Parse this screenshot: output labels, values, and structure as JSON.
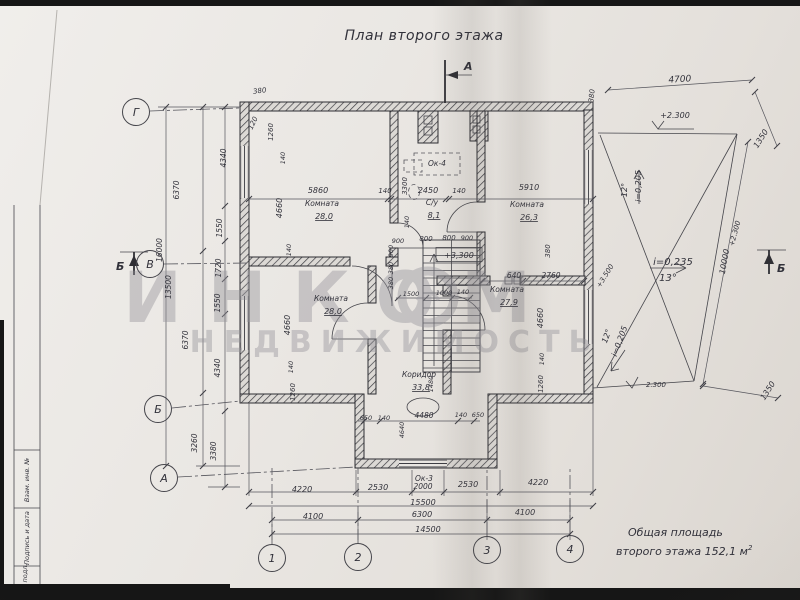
{
  "title": {
    "text": "План второго этажа"
  },
  "summary": {
    "line1": "Общая площадь",
    "line2": "второго этажа 152,1 м",
    "sup": "2"
  },
  "watermark": {
    "brand": "ИНКОМ",
    "sub": "НЕДВИЖИМОСТЬ"
  },
  "title_block_fields": [
    {
      "label": "Взам. инв. №"
    },
    {
      "label": "Подпись и дата"
    },
    {
      "label": "Инв. № подл."
    }
  ],
  "axis_bubbles": [
    {
      "label": "Г",
      "x": 136,
      "y": 112
    },
    {
      "label": "В",
      "x": 150,
      "y": 264
    },
    {
      "label": "Б",
      "x": 158,
      "y": 409
    },
    {
      "label": "А",
      "x": 164,
      "y": 478
    },
    {
      "label": "1",
      "x": 272,
      "y": 558
    },
    {
      "label": "2",
      "x": 358,
      "y": 557
    },
    {
      "label": "3",
      "x": 487,
      "y": 550
    },
    {
      "label": "4",
      "x": 570,
      "y": 549
    }
  ],
  "section_marks": [
    {
      "label": "А",
      "x": 464,
      "y": 70
    },
    {
      "label": "Б",
      "x": 116,
      "y": 270
    },
    {
      "label": "Б",
      "x": 777,
      "y": 272
    }
  ],
  "rooms": [
    {
      "name": "Комната",
      "area": "28,0",
      "x": 322,
      "y": 206
    },
    {
      "name": "С/у",
      "area": "8,1",
      "x": 432,
      "y": 205
    },
    {
      "name": "Комната",
      "area": "26,3",
      "x": 527,
      "y": 207
    },
    {
      "name": "Комната",
      "area": "28,0",
      "x": 331,
      "y": 301
    },
    {
      "name": "Комната",
      "area": "27,9",
      "x": 507,
      "y": 292
    },
    {
      "name": "Коридор",
      "area": "33,8",
      "x": 419,
      "y": 377
    }
  ],
  "window_labels": [
    {
      "label": "Ок-4",
      "x": 437,
      "y": 166
    },
    {
      "label": "Ок-3",
      "x": 424,
      "y": 481
    }
  ],
  "level_marks": [
    {
      "t": "+3,300",
      "x": 459,
      "y": 258,
      "fs": 8,
      "box": true
    },
    {
      "t": "+2.300",
      "x": 675,
      "y": 118,
      "fs": 8
    },
    {
      "t": "+2.300",
      "x": 737,
      "y": 234,
      "r": -75,
      "fs": 7
    },
    {
      "t": "+3.500",
      "x": 607,
      "y": 277,
      "r": -58,
      "fs": 7
    },
    {
      "t": "2.300",
      "x": 656,
      "y": 387,
      "fs": 7
    }
  ],
  "slope_marks": [
    {
      "t": "i=0,205",
      "x": 641,
      "y": 186,
      "r": -90,
      "fs": 8
    },
    {
      "t": "12°",
      "x": 627,
      "y": 190,
      "r": -90,
      "fs": 8
    },
    {
      "t": "i=0,235",
      "x": 673,
      "y": 265,
      "fs": 10
    },
    {
      "t": "13°",
      "x": 668,
      "y": 281,
      "fs": 10
    },
    {
      "t": "i=0,205",
      "x": 622,
      "y": 342,
      "r": -70,
      "fs": 8
    },
    {
      "t": "12°",
      "x": 609,
      "y": 337,
      "r": -70,
      "fs": 8
    }
  ],
  "dimensions": [
    {
      "t": "5860",
      "x": 318,
      "y": 193
    },
    {
      "t": "140",
      "x": 385,
      "y": 193,
      "fs": 7
    },
    {
      "t": "2450",
      "x": 428,
      "y": 193
    },
    {
      "t": "140",
      "x": 459,
      "y": 193,
      "fs": 7
    },
    {
      "t": "5910",
      "x": 529,
      "y": 190
    },
    {
      "t": "3300",
      "x": 407,
      "y": 186,
      "r": -90,
      "fs": 7
    },
    {
      "t": "380",
      "x": 260,
      "y": 93,
      "r": -8,
      "fs": 7
    },
    {
      "t": "120",
      "x": 255,
      "y": 124,
      "r": -65,
      "fs": 7
    },
    {
      "t": "1260",
      "x": 273,
      "y": 132,
      "r": -90,
      "fs": 7
    },
    {
      "t": "140",
      "x": 285,
      "y": 158,
      "r": -90,
      "fs": 6.5
    },
    {
      "t": "380",
      "x": 594,
      "y": 96,
      "r": -85,
      "fs": 7
    },
    {
      "t": "4660",
      "x": 282,
      "y": 208,
      "r": -90,
      "fs": 8
    },
    {
      "t": "140",
      "x": 291,
      "y": 250,
      "r": -90,
      "fs": 6.5
    },
    {
      "t": "140",
      "x": 409,
      "y": 222,
      "r": -90,
      "fs": 6.5
    },
    {
      "t": "900",
      "x": 398,
      "y": 243,
      "fs": 6.5
    },
    {
      "t": "800",
      "x": 426,
      "y": 241,
      "fs": 7
    },
    {
      "t": "800",
      "x": 449,
      "y": 240,
      "fs": 7
    },
    {
      "t": "900",
      "x": 467,
      "y": 240,
      "fs": 6.5
    },
    {
      "t": "900",
      "x": 393,
      "y": 251,
      "r": -90,
      "fs": 6.5
    },
    {
      "t": "380",
      "x": 393,
      "y": 268,
      "r": -90,
      "fs": 6.5
    },
    {
      "t": "380",
      "x": 393,
      "y": 283,
      "r": -90,
      "fs": 6.5
    },
    {
      "t": "1500",
      "x": 411,
      "y": 296,
      "fs": 6.5
    },
    {
      "t": "1000",
      "x": 444,
      "y": 295,
      "fs": 6.5
    },
    {
      "t": "140",
      "x": 463,
      "y": 294,
      "fs": 6.5
    },
    {
      "t": "380",
      "x": 550,
      "y": 251,
      "r": -90,
      "fs": 7
    },
    {
      "t": "640",
      "x": 514,
      "y": 278,
      "fs": 7.5
    },
    {
      "t": "2760",
      "x": 551,
      "y": 278,
      "fs": 7.5
    },
    {
      "t": "4660",
      "x": 290,
      "y": 325,
      "r": -90,
      "fs": 8
    },
    {
      "t": "140",
      "x": 293,
      "y": 367,
      "r": -90,
      "fs": 6.5
    },
    {
      "t": "1260",
      "x": 295,
      "y": 392,
      "r": -90,
      "fs": 7
    },
    {
      "t": "4660",
      "x": 543,
      "y": 318,
      "r": -90,
      "fs": 8
    },
    {
      "t": "140",
      "x": 544,
      "y": 359,
      "r": -90,
      "fs": 6.5
    },
    {
      "t": "1260",
      "x": 543,
      "y": 384,
      "r": -90,
      "fs": 7
    },
    {
      "t": "1480",
      "x": 433,
      "y": 384,
      "r": -90,
      "fs": 6.5
    },
    {
      "t": "650",
      "x": 366,
      "y": 420,
      "fs": 6.5
    },
    {
      "t": "140",
      "x": 384,
      "y": 420,
      "fs": 6.5
    },
    {
      "t": "4480",
      "x": 424,
      "y": 418,
      "fs": 7.5
    },
    {
      "t": "4640",
      "x": 404,
      "y": 430,
      "r": -90,
      "fs": 6.5
    },
    {
      "t": "140",
      "x": 461,
      "y": 417,
      "fs": 6.5
    },
    {
      "t": "650",
      "x": 478,
      "y": 417,
      "fs": 6.5
    },
    {
      "t": "2000",
      "x": 423,
      "y": 489,
      "fs": 7.5
    },
    {
      "t": "4220",
      "x": 302,
      "y": 492,
      "fs": 8
    },
    {
      "t": "2530",
      "x": 378,
      "y": 490,
      "fs": 8
    },
    {
      "t": "2530",
      "x": 468,
      "y": 487,
      "fs": 8
    },
    {
      "t": "4220",
      "x": 538,
      "y": 485,
      "fs": 8
    },
    {
      "t": "15500",
      "x": 423,
      "y": 505,
      "fs": 8
    },
    {
      "t": "4100",
      "x": 313,
      "y": 519,
      "fs": 8
    },
    {
      "t": "6300",
      "x": 422,
      "y": 517,
      "fs": 8
    },
    {
      "t": "4100",
      "x": 525,
      "y": 515,
      "fs": 8
    },
    {
      "t": "14500",
      "x": 428,
      "y": 532,
      "fs": 8
    },
    {
      "t": "4340",
      "x": 226,
      "y": 158,
      "r": -90,
      "fs": 7.5
    },
    {
      "t": "1550",
      "x": 222,
      "y": 228,
      "r": -90,
      "fs": 7.5
    },
    {
      "t": "1720",
      "x": 221,
      "y": 268,
      "r": -90,
      "fs": 7.5
    },
    {
      "t": "1550",
      "x": 220,
      "y": 303,
      "r": -90,
      "fs": 7.5
    },
    {
      "t": "4340",
      "x": 220,
      "y": 368,
      "r": -90,
      "fs": 7.5
    },
    {
      "t": "3380",
      "x": 216,
      "y": 451,
      "r": -90,
      "fs": 7.5
    },
    {
      "t": "6370",
      "x": 179,
      "y": 190,
      "r": -90,
      "fs": 7.5
    },
    {
      "t": "6370",
      "x": 188,
      "y": 340,
      "r": -90,
      "fs": 7.5
    },
    {
      "t": "3260",
      "x": 197,
      "y": 443,
      "r": -90,
      "fs": 7.5
    },
    {
      "t": "16000",
      "x": 162,
      "y": 250,
      "r": -90,
      "fs": 7.5
    },
    {
      "t": "13500",
      "x": 171,
      "y": 287,
      "r": -90,
      "fs": 7.5
    },
    {
      "t": "4700",
      "x": 680,
      "y": 82,
      "r": -4,
      "fs": 9
    },
    {
      "t": "1350",
      "x": 763,
      "y": 140,
      "r": -58,
      "fs": 8
    },
    {
      "t": "10000",
      "x": 727,
      "y": 262,
      "r": -80,
      "fs": 8
    },
    {
      "t": "1350",
      "x": 770,
      "y": 392,
      "r": -58,
      "fs": 8
    }
  ],
  "colors": {
    "paper": "#e9e6e2",
    "ink": "#31313a",
    "watermark": "#95939a",
    "edge": "#161616"
  }
}
